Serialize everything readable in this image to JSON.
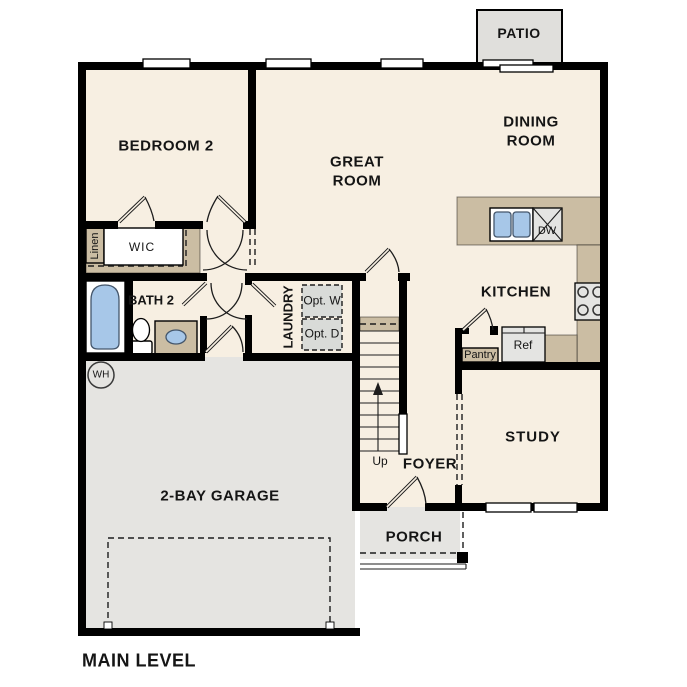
{
  "title": "MAIN LEVEL",
  "colors": {
    "wall": "#000000",
    "line": "#1d1d1d",
    "floor": "#f7efe2",
    "garage": "#e5e4e1",
    "patio": "#e0dfdc",
    "counter": "#cbbda3",
    "fixture": "#e4e4e2",
    "optbox": "#d9dbd8",
    "blue": "#a7c7e8"
  },
  "rooms": {
    "patio": "PATIO",
    "bedroom2": "BEDROOM 2",
    "great_room": "GREAT ROOM",
    "dining_room": "DINING ROOM",
    "kitchen": "KITCHEN",
    "study": "STUDY",
    "foyer": "FOYER",
    "porch": "PORCH",
    "garage": "2-BAY GARAGE",
    "bath2": "BATH 2",
    "laundry": "LAUNDRY",
    "wic": "WIC"
  },
  "fixtures": {
    "linen": "Linen",
    "opt_washer": "Opt. W",
    "opt_dryer": "Opt. D",
    "pantry": "Pantry",
    "ref": "Ref",
    "dishwasher": "DW",
    "water_heater": "WH",
    "stairs_up": "Up"
  }
}
